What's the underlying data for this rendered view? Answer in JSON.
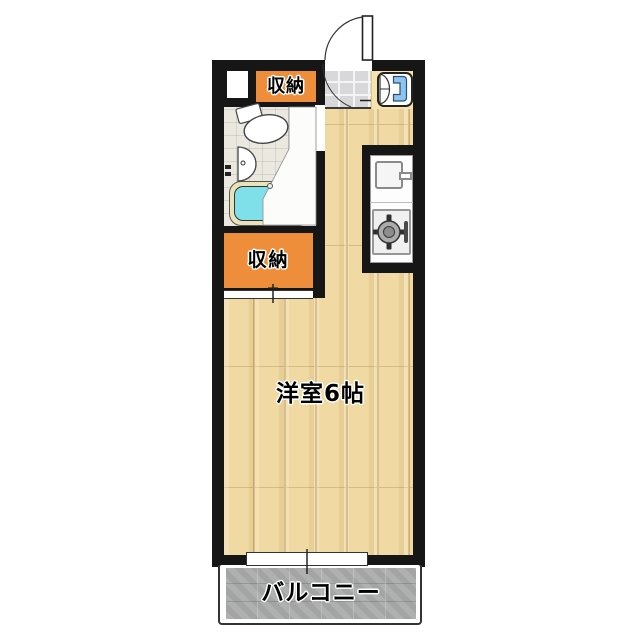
{
  "plan": {
    "labels": {
      "closet_top": "収納",
      "closet_mid": "収納",
      "main_room": "洋室6帖",
      "balcony": "バルコニー"
    },
    "colors": {
      "wall": "#161616",
      "wood_floor": "#f0d9a2",
      "closet_orange": "#ef8e3a",
      "bathtub_cyan": "#7fe0e9",
      "balcony_gray": "#aaabab",
      "washer_blue": "#8cc5f1",
      "entrance_tile": "#d8d8da"
    },
    "fixtures": [
      "entrance-door",
      "washing-machine",
      "toilet",
      "washbasin",
      "bathtub",
      "kitchen-sink",
      "gas-stove",
      "sliding-closet-door",
      "window",
      "balcony"
    ]
  }
}
